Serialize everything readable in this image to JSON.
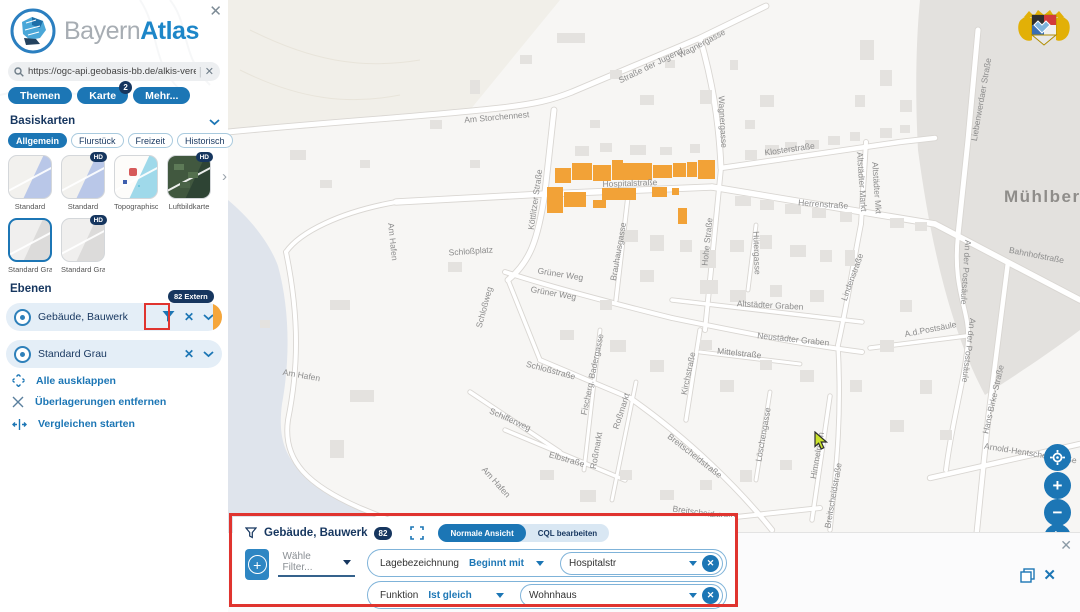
{
  "app": {
    "brand_light": "Bayern",
    "brand_bold": "Atlas"
  },
  "icons": {
    "close": "✕",
    "chevron_right": "›",
    "plus": "+",
    "minus": "−",
    "hd": "HD",
    "pipe": "|"
  },
  "search": {
    "value": "https://ogc-api.geobasis-bb.de/alkis-verein"
  },
  "tabs": [
    {
      "label": "Themen"
    },
    {
      "label": "Karte",
      "badge": "2"
    },
    {
      "label": "Mehr..."
    }
  ],
  "basemaps": {
    "title": "Basiskarten",
    "filters": [
      "Allgemein",
      "Flurstück",
      "Freizeit",
      "Historisch"
    ],
    "active_filter": "Allgemein",
    "thumbnails": [
      {
        "label": "Standard"
      },
      {
        "label": "Standard",
        "badge": "HD"
      },
      {
        "label": "Topographisch"
      },
      {
        "label": "Luftbildkarte",
        "badge": "HD"
      },
      {
        "label": "Standard Grau",
        "selected": true
      },
      {
        "label": "Standard Grau",
        "badge": "HD"
      }
    ]
  },
  "layers": {
    "title": "Ebenen",
    "items": [
      {
        "label": "Gebäude, Bauwerk",
        "badge": "82 Extern"
      },
      {
        "label": "Standard Grau"
      }
    ],
    "actions": [
      "Alle ausklappen",
      "Überlagerungen entfernen",
      "Vergleichen starten"
    ]
  },
  "filter_panel": {
    "title": "Gebäude, Bauwerk",
    "count": "82",
    "views": [
      "Normale Ansicht",
      "CQL bearbeiten"
    ],
    "active_view": "Normale Ansicht",
    "choose_filter_placeholder": "Wähle Filter...",
    "rows": [
      {
        "field": "Lagebezeichnung",
        "operator": "Beginnt mit",
        "value": "Hospitalstr"
      },
      {
        "field": "Funktion",
        "operator": "Ist gleich",
        "value": "Wohnhaus"
      }
    ]
  },
  "map": {
    "place_label": "Mühlberg",
    "street_labels": [
      {
        "t": "Am Storchennest",
        "x": 497,
        "y": 120,
        "r": -5
      },
      {
        "t": "Straße der Jugend",
        "x": 652,
        "y": 68,
        "r": -26
      },
      {
        "t": "Wagnergasse",
        "x": 703,
        "y": 46,
        "r": -28
      },
      {
        "t": "Wagnergasse",
        "x": 720,
        "y": 122,
        "r": 87
      },
      {
        "t": "Köttlitzer Straße",
        "x": 538,
        "y": 200,
        "r": -82
      },
      {
        "t": "Hospitalstraße",
        "x": 630,
        "y": 186,
        "r": -2
      },
      {
        "t": "Klosterstraße",
        "x": 790,
        "y": 152,
        "r": -8
      },
      {
        "t": "Herrenstraße",
        "x": 823,
        "y": 207,
        "r": 4
      },
      {
        "t": "Altstädter Markt",
        "x": 859,
        "y": 182,
        "r": 86
      },
      {
        "t": "Altstädter Mkt",
        "x": 874,
        "y": 188,
        "r": 86
      },
      {
        "t": "Liebenwerdaer Straße",
        "x": 984,
        "y": 100,
        "r": -80
      },
      {
        "t": "Hohe Straße",
        "x": 710,
        "y": 242,
        "r": -84
      },
      {
        "t": "Hütergasse",
        "x": 754,
        "y": 253,
        "r": 88
      },
      {
        "t": "Bahnhofstraße",
        "x": 1036,
        "y": 258,
        "r": 11
      },
      {
        "t": "An der Postsäule",
        "x": 963,
        "y": 272,
        "r": 94
      },
      {
        "t": "An der Postsäule",
        "x": 966,
        "y": 350,
        "r": 97
      },
      {
        "t": "A.d.Postsäule",
        "x": 931,
        "y": 332,
        "r": -11
      },
      {
        "t": "Hans-Birke-Straße",
        "x": 996,
        "y": 400,
        "r": -77
      },
      {
        "t": "Arnold-Hentschel-Straße",
        "x": 1030,
        "y": 456,
        "r": 9
      },
      {
        "t": "Lindenstraße",
        "x": 855,
        "y": 278,
        "r": -70
      },
      {
        "t": "Am Hafen",
        "x": 390,
        "y": 242,
        "r": 84
      },
      {
        "t": "Am Hafen",
        "x": 301,
        "y": 378,
        "r": 10
      },
      {
        "t": "Am Hafen",
        "x": 494,
        "y": 484,
        "r": 48
      },
      {
        "t": "Schloßplatz",
        "x": 471,
        "y": 254,
        "r": -4
      },
      {
        "t": "Schloßweg",
        "x": 487,
        "y": 308,
        "r": -75
      },
      {
        "t": "Grüner Weg",
        "x": 560,
        "y": 277,
        "r": 9
      },
      {
        "t": "Grüner Weg",
        "x": 553,
        "y": 296,
        "r": 10
      },
      {
        "t": "Schloßstraße",
        "x": 550,
        "y": 373,
        "r": 15
      },
      {
        "t": "Brauhausgasse",
        "x": 621,
        "y": 252,
        "r": -80
      },
      {
        "t": "Fischerg. Badergasse",
        "x": 595,
        "y": 375,
        "r": -78
      },
      {
        "t": "Roßmarkt",
        "x": 624,
        "y": 412,
        "r": -72
      },
      {
        "t": "Roßmarkt",
        "x": 599,
        "y": 451,
        "r": -80
      },
      {
        "t": "Schifferweg",
        "x": 509,
        "y": 422,
        "r": 24
      },
      {
        "t": "Elbstraße",
        "x": 566,
        "y": 462,
        "r": 16
      },
      {
        "t": "Kirchstraße",
        "x": 691,
        "y": 374,
        "r": -78
      },
      {
        "t": "Mittelstraße",
        "x": 739,
        "y": 356,
        "r": 6
      },
      {
        "t": "Altstädter Graben",
        "x": 770,
        "y": 308,
        "r": 3
      },
      {
        "t": "Neustädter Graben",
        "x": 793,
        "y": 342,
        "r": 6
      },
      {
        "t": "Löschengasse",
        "x": 766,
        "y": 435,
        "r": -80
      },
      {
        "t": "Himmelreich",
        "x": 820,
        "y": 456,
        "r": -80
      },
      {
        "t": "Breitscheidstraße",
        "x": 693,
        "y": 458,
        "r": 38
      },
      {
        "t": "Breitscheidstraße",
        "x": 705,
        "y": 516,
        "r": 8
      },
      {
        "t": "Breitscheidstraße",
        "x": 836,
        "y": 496,
        "r": -80
      }
    ],
    "highlighted_buildings": [
      [
        555,
        168,
        16,
        15
      ],
      [
        572,
        163,
        20,
        17
      ],
      [
        593,
        165,
        18,
        16
      ],
      [
        612,
        160,
        11,
        20
      ],
      [
        623,
        163,
        29,
        17
      ],
      [
        653,
        165,
        19,
        13
      ],
      [
        673,
        163,
        13,
        14
      ],
      [
        687,
        162,
        10,
        15
      ],
      [
        698,
        160,
        17,
        19
      ],
      [
        547,
        187,
        16,
        26
      ],
      [
        564,
        192,
        22,
        15
      ],
      [
        593,
        200,
        13,
        8
      ],
      [
        602,
        188,
        34,
        12
      ],
      [
        652,
        187,
        15,
        10
      ],
      [
        672,
        188,
        7,
        7
      ],
      [
        678,
        208,
        9,
        16
      ]
    ]
  },
  "colors": {
    "primary_blue": "#1c76b5",
    "navy": "#16365f",
    "highlight_orange": "#f2a237",
    "annotation_red": "#e0342f",
    "water": "#dfe4ec",
    "road": "#ffffff",
    "building_gray": "#e4e2df"
  }
}
